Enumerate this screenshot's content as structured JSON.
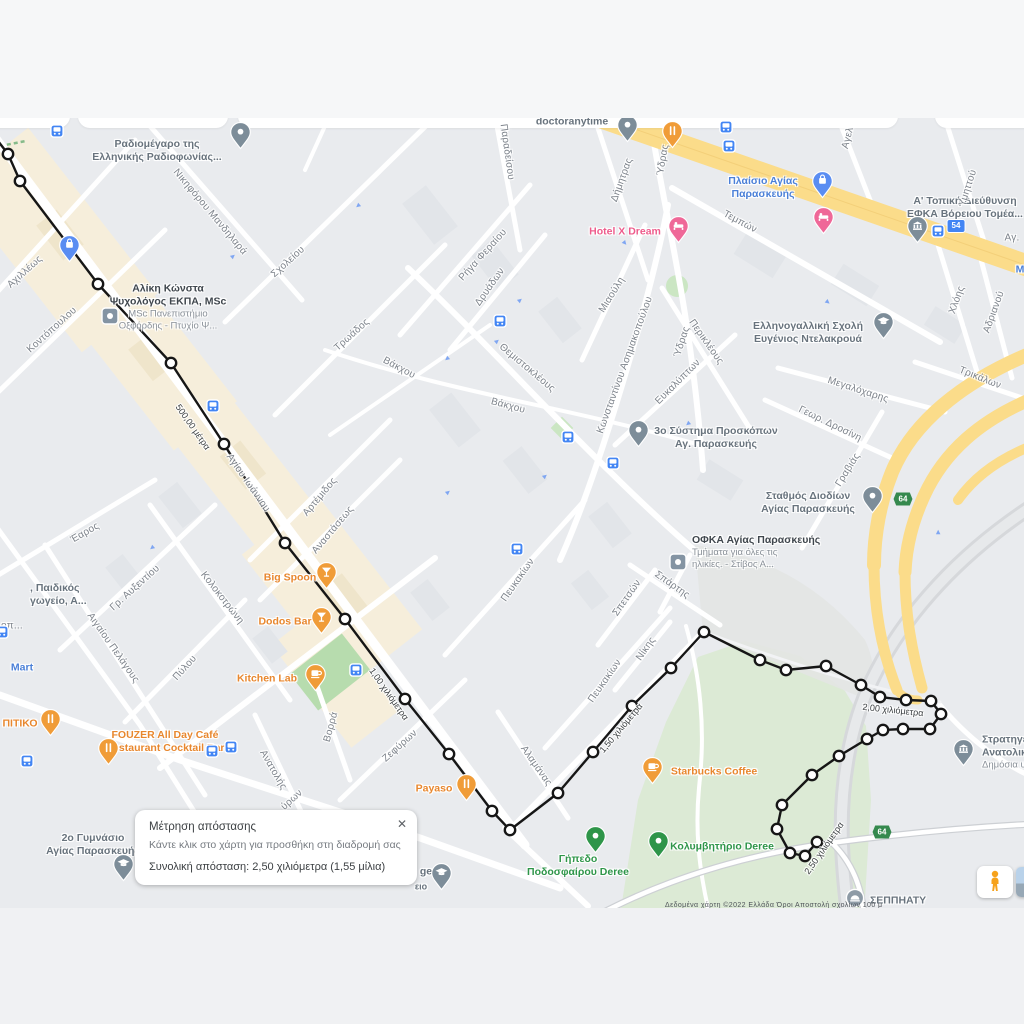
{
  "dialog": {
    "title": "Μέτρηση απόστασης",
    "hint": "Κάντε κλικ στο χάρτη για προσθήκη στη διαδρομή σας",
    "total": "Συνολική απόσταση: 2,50 χιλιόμετρα (1,55 μίλια)",
    "close_label": "✕"
  },
  "colors": {
    "poi_orange": "#f09c38",
    "poi_pink": "#ef6898",
    "poi_blue": "#5a8df2",
    "poi_gray": "#7d8d99",
    "poi_green": "#2e9549",
    "square_icon": "#8494a3",
    "bus": "#4285f4",
    "route": "#161616",
    "road_yellow": "#fbdc8a"
  },
  "map": {
    "attribution": "Δεδομένα χάρτη ©2022      Ελλάδα      Όροι      Αποστολή σχολίων     100 μ",
    "poi_labels": [
      {
        "id": "doctoranytime",
        "cls": "gray",
        "x": 572,
        "y": 122,
        "lines": [
          "doctoranytime"
        ]
      },
      {
        "id": "radiomegaro",
        "cls": "gray",
        "x": 157,
        "y": 151,
        "lines": [
          "Ραδιομέγαρο της",
          "Ελληνικής Ραδιοφωνίας..."
        ]
      },
      {
        "id": "plaisio-agias-paraskevis",
        "cls": "blue",
        "x": 763,
        "y": 188,
        "lines": [
          "Πλαίσιο Αγίας",
          "Παρασκευής"
        ]
      },
      {
        "id": "efka-voreiou-tomea",
        "cls": "gray",
        "x": 965,
        "y": 208,
        "lines": [
          "Α' Τοπική Διεύθυνση",
          "ΕΦΚΑ Βόρειου Τομέα..."
        ]
      },
      {
        "id": "hotel-x-dream",
        "cls": "pink",
        "x": 625,
        "y": 232,
        "lines": [
          "Hotel X Dream"
        ]
      },
      {
        "id": "aliki-konsta",
        "cls": "dark",
        "x": 168,
        "y": 307,
        "lines": [
          "Αλίκη Κώνστα",
          "Ψυχολόγος ΕΚΠΑ, MSc"
        ],
        "sub": [
          "MSc Πανεπιστήμιο",
          "Οξφόρδης - Πτυχίο Ψ..."
        ]
      },
      {
        "id": "ellinogalliki-scholi",
        "cls": "gray",
        "x": 808,
        "y": 333,
        "lines": [
          "Ελληνογαλλική Σχολή",
          "Ευγένιος Ντελακρουά"
        ]
      },
      {
        "id": "proskopoi",
        "cls": "gray",
        "x": 716,
        "y": 438,
        "lines": [
          "3ο Σύστημα Προσκόπων",
          "Αγ. Παρασκευής"
        ]
      },
      {
        "id": "stathmos-diodion",
        "cls": "gray",
        "x": 808,
        "y": 503,
        "lines": [
          "Σταθμός Διοδίων",
          "Αγίας Παρασκευής"
        ]
      },
      {
        "id": "ofka",
        "cls": "dark",
        "x": 692,
        "y": 552,
        "align": "left",
        "lines": [
          "ΟΦΚΑ Αγίας Παρασκευής"
        ],
        "sub": [
          "Τμήματα για όλες τις",
          "ηλικίες. - Στίβος Α..."
        ]
      },
      {
        "id": "big-spoon",
        "cls": "orange",
        "x": 290,
        "y": 578,
        "lines": [
          "Big Spoon"
        ]
      },
      {
        "id": "dodos-bar",
        "cls": "orange",
        "x": 285,
        "y": 622,
        "lines": [
          "Dodos Bar"
        ]
      },
      {
        "id": "kitchen-lab",
        "cls": "orange",
        "x": 267,
        "y": 679,
        "lines": [
          "Kitchen Lab"
        ]
      },
      {
        "id": "pitiko",
        "cls": "orange",
        "x": 20,
        "y": 724,
        "lines": [
          "ΠΙΤΙΚΟ"
        ]
      },
      {
        "id": "fouzer",
        "cls": "orange",
        "x": 165,
        "y": 742,
        "lines": [
          "FOUZER All Day Café",
          "Restaurant Cocktail Bar"
        ]
      },
      {
        "id": "payaso",
        "cls": "orange",
        "x": 434,
        "y": 789,
        "lines": [
          "Payaso"
        ]
      },
      {
        "id": "starbucks",
        "cls": "orange",
        "x": 714,
        "y": 772,
        "lines": [
          "Starbucks Coffee"
        ]
      },
      {
        "id": "gipedo-deree",
        "cls": "green",
        "x": 578,
        "y": 866,
        "lines": [
          "Γήπεδο",
          "Ποδοσφαίρου Deree"
        ]
      },
      {
        "id": "kolymbitirio-deree",
        "cls": "green",
        "x": 722,
        "y": 847,
        "lines": [
          "Κολυμβητήριο Deree"
        ]
      },
      {
        "id": "mart",
        "cls": "blue",
        "x": 22,
        "y": 668,
        "lines": [
          "Mart"
        ]
      },
      {
        "id": "paidikos-stathmos",
        "cls": "gray",
        "x": 30,
        "y": 595,
        "align": "left",
        "lines": [
          ", Παιδικός",
          "γωγείο, Α..."
        ]
      },
      {
        "id": "gymnasio-2",
        "cls": "gray",
        "x": 93,
        "y": 845,
        "lines": [
          "2ο Γυμνάσιο",
          "Αγίας Παρασκευής"
        ]
      },
      {
        "id": "stratigeio",
        "cls": "gray",
        "x": 982,
        "y": 752,
        "align": "left",
        "lines": [
          "Στρατηγε",
          "Ανατολικ"
        ],
        "sub": [
          "Δημόσια υπ"
        ]
      },
      {
        "id": "seppiaty",
        "cls": "gray",
        "x": 870,
        "y": 901,
        "align": "left",
        "lines": [
          "ΣΕΠΠΗΑΤΥ"
        ]
      },
      {
        "id": "college-ge",
        "cls": "gray",
        "x": 426,
        "y": 872,
        "lines": [
          "ge"
        ]
      },
      {
        "id": "college-eio",
        "cls": "gray",
        "x": 421,
        "y": 887,
        "size": 9,
        "lines": [
          "ειο"
        ]
      },
      {
        "id": "m-partial",
        "cls": "blue",
        "x": 1020,
        "y": 270,
        "lines": [
          "Μ"
        ]
      }
    ],
    "street_labels": [
      {
        "t": "Νικηφόρου Μανδηλαρά",
        "x": 210,
        "y": 212,
        "r": 50
      },
      {
        "t": "Σχολείου",
        "x": 288,
        "y": 262,
        "r": -42
      },
      {
        "t": "Αχιλλέως",
        "x": 25,
        "y": 272,
        "r": -42
      },
      {
        "t": "Κοντόπουλου",
        "x": 52,
        "y": 330,
        "r": -42
      },
      {
        "t": "Παραδείσου",
        "x": 507,
        "y": 152,
        "r": 82
      },
      {
        "t": "Δήμητρας",
        "x": 622,
        "y": 180,
        "r": -70
      },
      {
        "t": "Ύδρας",
        "x": 663,
        "y": 160,
        "r": -80
      },
      {
        "t": "Ύδρας",
        "x": 682,
        "y": 342,
        "r": -72
      },
      {
        "t": "Τεμπών",
        "x": 740,
        "y": 222,
        "r": 28
      },
      {
        "t": "Αγελ",
        "x": 848,
        "y": 138,
        "r": -75
      },
      {
        "t": "Υμηττού",
        "x": 968,
        "y": 188,
        "r": -72
      },
      {
        "t": "Αγ.",
        "x": 1012,
        "y": 238,
        "r": 0
      },
      {
        "t": "Ρήγα Φεραίου",
        "x": 483,
        "y": 255,
        "r": -48
      },
      {
        "t": "Δρυάδων",
        "x": 490,
        "y": 287,
        "r": -55
      },
      {
        "t": "Μιαούλη",
        "x": 612,
        "y": 295,
        "r": -58
      },
      {
        "t": "Τρωάδος",
        "x": 352,
        "y": 335,
        "r": -42
      },
      {
        "t": "Θεμιστοκλέους",
        "x": 527,
        "y": 368,
        "r": 40
      },
      {
        "t": "Κωνσταντίνου Ασημακοπούλου",
        "x": 625,
        "y": 365,
        "r": -70
      },
      {
        "t": "Περικλέους",
        "x": 706,
        "y": 342,
        "r": 55
      },
      {
        "t": "Ευκαλύπτων",
        "x": 678,
        "y": 382,
        "r": -45
      },
      {
        "t": "Βάκχου",
        "x": 399,
        "y": 368,
        "r": 28
      },
      {
        "t": "Βάκχου",
        "x": 508,
        "y": 406,
        "r": 15
      },
      {
        "t": "Χλόης",
        "x": 957,
        "y": 300,
        "r": -70
      },
      {
        "t": "Αδριανού",
        "x": 994,
        "y": 312,
        "r": -70
      },
      {
        "t": "Τρικάλων",
        "x": 980,
        "y": 378,
        "r": 22
      },
      {
        "t": "Μεγαλόχαρης",
        "x": 858,
        "y": 390,
        "r": 18
      },
      {
        "t": "Γεωρ. Δροσίνη",
        "x": 830,
        "y": 424,
        "r": 26
      },
      {
        "t": "Γραβιάς",
        "x": 848,
        "y": 470,
        "r": -58
      },
      {
        "t": "Αγίου Ιωάννου",
        "x": 248,
        "y": 483,
        "r": 55
      },
      {
        "t": "Αρτέμιδος",
        "x": 320,
        "y": 497,
        "r": -50
      },
      {
        "t": "Αναστάσεως",
        "x": 333,
        "y": 530,
        "r": -50
      },
      {
        "t": "Έαρος",
        "x": 85,
        "y": 533,
        "r": -30
      },
      {
        "t": "Γρ. Αυξεντίου",
        "x": 135,
        "y": 588,
        "r": -42
      },
      {
        "t": "Κολοκοτρώνη",
        "x": 222,
        "y": 598,
        "r": 52
      },
      {
        "t": "Αιγαίου Πελάγους",
        "x": 113,
        "y": 648,
        "r": 55
      },
      {
        "t": "Πύλου",
        "x": 185,
        "y": 668,
        "r": -48
      },
      {
        "t": "οπ...",
        "x": 12,
        "y": 626,
        "r": 0
      },
      {
        "t": "Σπάρτης",
        "x": 672,
        "y": 585,
        "r": 35
      },
      {
        "t": "Σπετσών",
        "x": 627,
        "y": 598,
        "r": -55
      },
      {
        "t": "Νίκης",
        "x": 646,
        "y": 649,
        "r": -55
      },
      {
        "t": "Πευκακίων",
        "x": 518,
        "y": 580,
        "r": -55
      },
      {
        "t": "Πευκακίων",
        "x": 605,
        "y": 681,
        "r": -55
      },
      {
        "t": "Βορρά",
        "x": 331,
        "y": 727,
        "r": -75
      },
      {
        "t": "Ανατολής",
        "x": 273,
        "y": 770,
        "r": 60
      },
      {
        "t": "Ζεφύρων",
        "x": 400,
        "y": 746,
        "r": -42
      },
      {
        "t": "ύρων",
        "x": 292,
        "y": 800,
        "r": -42
      },
      {
        "t": "Αλαμάνας",
        "x": 536,
        "y": 766,
        "r": 55
      }
    ],
    "distance_markers": [
      {
        "t": "500,00 μέτρα",
        "x": 193,
        "y": 427,
        "r": 55
      },
      {
        "t": "1,00 χιλιόμετρα",
        "x": 389,
        "y": 694,
        "r": 55
      },
      {
        "t": "1,50 χιλιόμετρα",
        "x": 621,
        "y": 728,
        "r": -50
      },
      {
        "t": "2,00 χιλιόμετρα",
        "x": 893,
        "y": 710,
        "r": 6
      },
      {
        "t": "2,50 χιλιόμετρα",
        "x": 824,
        "y": 848,
        "r": -55
      }
    ],
    "route_badges": [
      {
        "t": "54",
        "x": 956,
        "y": 226,
        "type": "blue"
      },
      {
        "t": "64",
        "x": 903,
        "y": 499,
        "type": "green"
      },
      {
        "t": "64",
        "x": 882,
        "y": 832,
        "type": "green"
      }
    ],
    "bus_stops": [
      [
        57,
        131
      ],
      [
        726,
        127
      ],
      [
        729,
        146
      ],
      [
        938,
        231
      ],
      [
        500,
        321
      ],
      [
        213,
        406
      ],
      [
        568,
        437
      ],
      [
        613,
        463
      ],
      [
        517,
        549
      ],
      [
        356,
        670
      ],
      [
        212,
        751
      ],
      [
        231,
        747
      ],
      [
        27,
        761
      ],
      [
        2,
        632
      ]
    ],
    "one_way_arrows": [
      [
        233,
        256,
        -40
      ],
      [
        447,
        359,
        140
      ],
      [
        520,
        300,
        -40
      ],
      [
        625,
        243,
        50
      ],
      [
        688,
        424,
        140
      ],
      [
        545,
        476,
        -40
      ],
      [
        152,
        548,
        140
      ],
      [
        448,
        492,
        -40
      ],
      [
        828,
        302,
        40
      ],
      [
        938,
        532,
        -90
      ],
      [
        358,
        206,
        140
      ],
      [
        497,
        341,
        -40
      ]
    ],
    "pins": [
      [
        627,
        142,
        "poi_gray",
        "dot",
        "doctoranytime"
      ],
      [
        672,
        148,
        "poi_orange",
        "fork",
        "restaurant-top"
      ],
      [
        240,
        149,
        "poi_gray",
        "dot",
        "radiomegaro"
      ],
      [
        69,
        262,
        "poi_blue",
        "bag",
        "shopping-left"
      ],
      [
        822,
        198,
        "poi_blue",
        "bag",
        "plaisio"
      ],
      [
        917,
        243,
        "poi_gray",
        "bank",
        "efka"
      ],
      [
        678,
        243,
        "poi_pink",
        "bed",
        "hotel-x-dream"
      ],
      [
        823,
        234,
        "poi_pink",
        "bed",
        "hotel-2"
      ],
      [
        883,
        339,
        "poi_gray",
        "cap",
        "ellinogalliki-scholi"
      ],
      [
        638,
        447,
        "poi_gray",
        "dot",
        "proskopoi"
      ],
      [
        872,
        513,
        "poi_gray",
        "dot",
        "stathmos-diodion"
      ],
      [
        963,
        766,
        "poi_gray",
        "bank",
        "stratigeio"
      ],
      [
        123,
        881,
        "poi_gray",
        "cap",
        "gymnasio-2"
      ],
      [
        441,
        890,
        "poi_gray",
        "cap",
        "college"
      ],
      [
        326,
        589,
        "poi_orange",
        "tri",
        "big-spoon"
      ],
      [
        321,
        634,
        "poi_orange",
        "tri",
        "dodos-bar"
      ],
      [
        315,
        691,
        "poi_orange",
        "cup",
        "kitchen-lab"
      ],
      [
        50,
        736,
        "poi_orange",
        "fork",
        "pitiko"
      ],
      [
        108,
        765,
        "poi_orange",
        "fork",
        "fouzer"
      ],
      [
        466,
        801,
        "poi_orange",
        "fork",
        "payaso"
      ],
      [
        652,
        784,
        "poi_orange",
        "cup",
        "starbucks"
      ],
      [
        595,
        853,
        "poi_green",
        "dot",
        "gipedo-deree"
      ],
      [
        658,
        858,
        "poi_green",
        "dot",
        "kolymbitirio-deree"
      ]
    ],
    "square_icons": [
      [
        110,
        316,
        "aliki-konsta"
      ],
      [
        678,
        562,
        "ofka"
      ]
    ],
    "stadium_icon": [
      855,
      898
    ],
    "route": {
      "total_km": "2,50",
      "total_miles": "1,55",
      "points": [
        [
          -12,
          128
        ],
        [
          8,
          154
        ],
        [
          20,
          181
        ],
        [
          98,
          284
        ],
        [
          171,
          363
        ],
        [
          224,
          444
        ],
        [
          285,
          543
        ],
        [
          345,
          619
        ],
        [
          405,
          699
        ],
        [
          449,
          754
        ],
        [
          492,
          811
        ],
        [
          510,
          830
        ],
        [
          558,
          793
        ],
        [
          593,
          752
        ],
        [
          632,
          706
        ],
        [
          671,
          668
        ],
        [
          704,
          632
        ],
        [
          760,
          660
        ],
        [
          786,
          670
        ],
        [
          826,
          666
        ],
        [
          861,
          685
        ],
        [
          880,
          697
        ],
        [
          906,
          700
        ],
        [
          931,
          701
        ],
        [
          941,
          714
        ],
        [
          930,
          729
        ],
        [
          903,
          729
        ],
        [
          883,
          730
        ],
        [
          867,
          739
        ],
        [
          839,
          756
        ],
        [
          812,
          775
        ],
        [
          782,
          805
        ],
        [
          777,
          829
        ],
        [
          790,
          853
        ],
        [
          805,
          856
        ],
        [
          817,
          842
        ]
      ]
    }
  }
}
